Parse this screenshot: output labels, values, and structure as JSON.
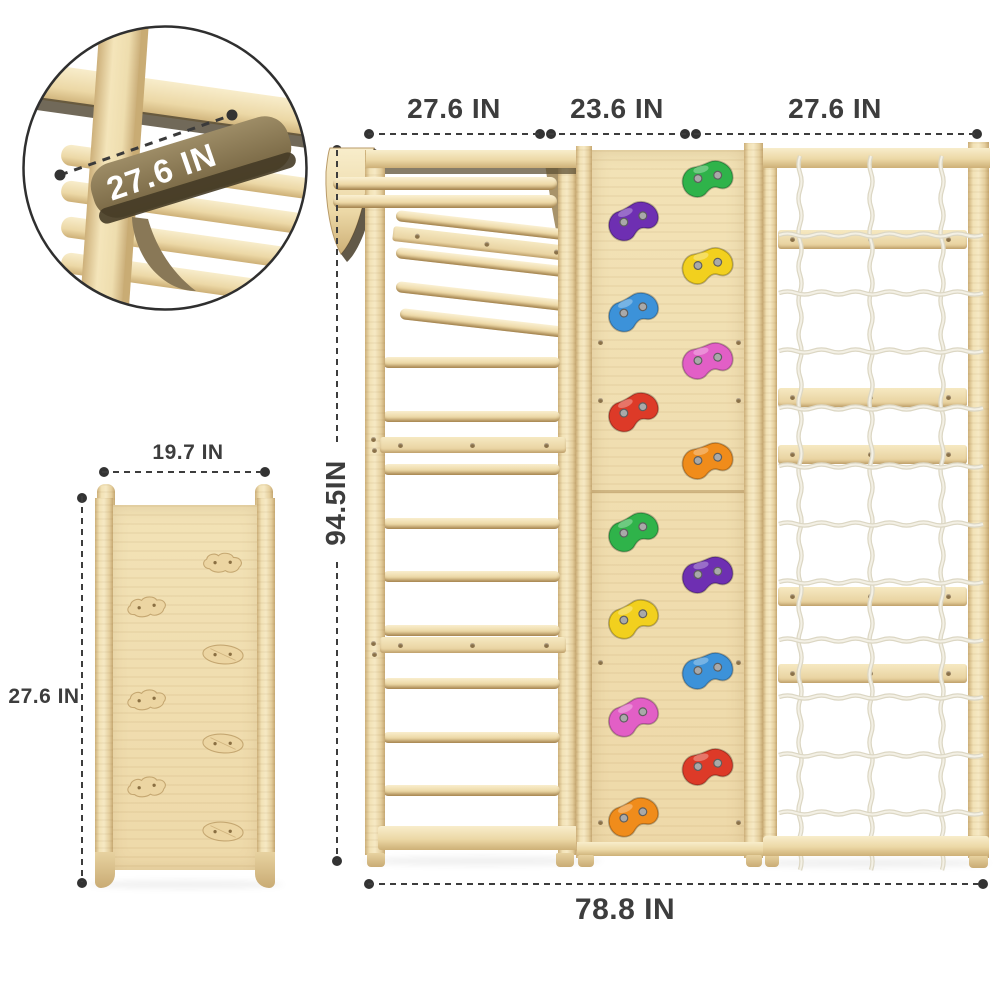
{
  "page": {
    "description": "Wooden climbing gym dimension diagram"
  },
  "dims": {
    "inset_label": "27.6 IN",
    "ramp_width": "19.7 IN",
    "ramp_height": "27.6 IN",
    "main_top": [
      "27.6 IN",
      "23.6 IN",
      "27.6 IN"
    ],
    "main_height": "94.5IN",
    "main_width": "78.8 IN"
  },
  "main": {
    "ladder": {
      "rung_count": 9,
      "board_count": 2
    },
    "wall": {
      "holds": [
        {
          "color": "green",
          "hex": "#2fb34a",
          "side": "right"
        },
        {
          "color": "purple",
          "hex": "#6e2fb2",
          "side": "left"
        },
        {
          "color": "yellow",
          "hex": "#f2d01e",
          "side": "right"
        },
        {
          "color": "blue",
          "hex": "#3c92d9",
          "side": "left"
        },
        {
          "color": "pink",
          "hex": "#e25fc6",
          "side": "right"
        },
        {
          "color": "red",
          "hex": "#dd3a28",
          "side": "left"
        },
        {
          "color": "orange",
          "hex": "#f08c1b",
          "side": "right"
        },
        {
          "color": "green",
          "hex": "#2fb34a",
          "side": "left"
        },
        {
          "color": "purple",
          "hex": "#6e2fb2",
          "side": "right"
        },
        {
          "color": "yellow",
          "hex": "#f2d01e",
          "side": "left"
        },
        {
          "color": "blue",
          "hex": "#3c92d9",
          "side": "right"
        },
        {
          "color": "pink",
          "hex": "#e25fc6",
          "side": "left"
        },
        {
          "color": "red",
          "hex": "#dd3a28",
          "side": "right"
        },
        {
          "color": "orange",
          "hex": "#f08c1b",
          "side": "left"
        }
      ]
    },
    "net": {
      "vertical_ropes": 3,
      "horizontal_ropes": 11,
      "slat_count": 5
    }
  },
  "ramp": {
    "hold_count": 7
  },
  "colors": {
    "wood_light": "#f3e4bc",
    "wood_mid": "#e8d2a0",
    "wood_dark": "#c9ab74",
    "bracket_dark": "#7c6b49",
    "dimension_text": "#3d3d3d",
    "rope": "#e5e0cf",
    "hold_screw": "#a9a9a9"
  }
}
